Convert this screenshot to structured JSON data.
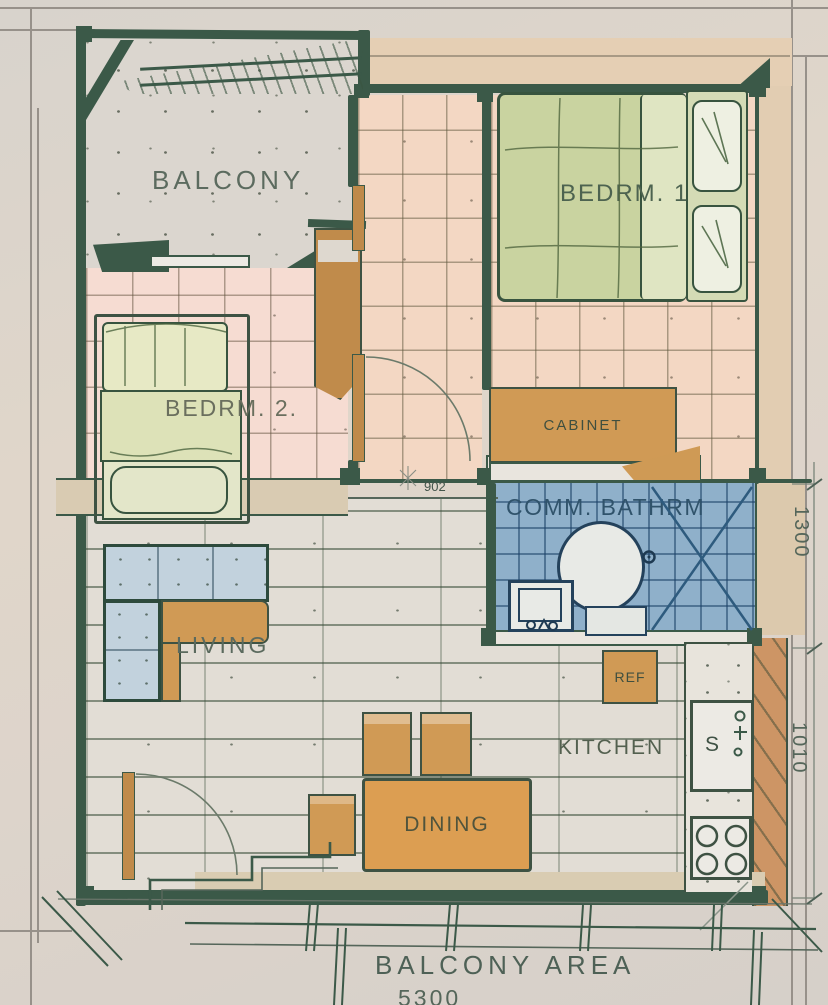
{
  "drawing": {
    "type": "hand-drawn watercolor apartment floor plan",
    "rooms": {
      "balcony": {
        "label": "BALCONY"
      },
      "bedroom1": {
        "label": "BEDRM. 1"
      },
      "bedroom2": {
        "label": "BEDRM. 2."
      },
      "bathroom": {
        "label": "COMM. BATHRM"
      },
      "living": {
        "label": "LIVING"
      },
      "kitchen": {
        "label": "KITCHEN"
      },
      "dining": {
        "label": "DINING"
      },
      "balcony_area": {
        "label": "BALCONY AREA"
      }
    },
    "furniture": {
      "cabinet": {
        "label": "CABINET"
      },
      "refrigerator": {
        "label": "REF"
      },
      "sink": {
        "label": "S"
      }
    },
    "dimensions": {
      "corridor_width": "902",
      "bathroom_depth": "1300",
      "kitchen_depth": "1010",
      "overall_width": "5300"
    },
    "colors": {
      "paper": "#d9d3cc",
      "wall_green": "#3b5948",
      "label_green": "#54675a",
      "floor_peach": "#f3d7c3",
      "floor_pink": "#f6dcd2",
      "floor_brick": "#e2ddd5",
      "bathroom_blue": "#8fb0ca",
      "bathroom_line": "#2e5b7e",
      "bed_green": "#c9d3a0",
      "sofa_blue": "#c2d2dd",
      "furniture_orange": "#d09a55",
      "wall_tan": "#d9cbb2",
      "terracotta": "#cd9565"
    }
  }
}
